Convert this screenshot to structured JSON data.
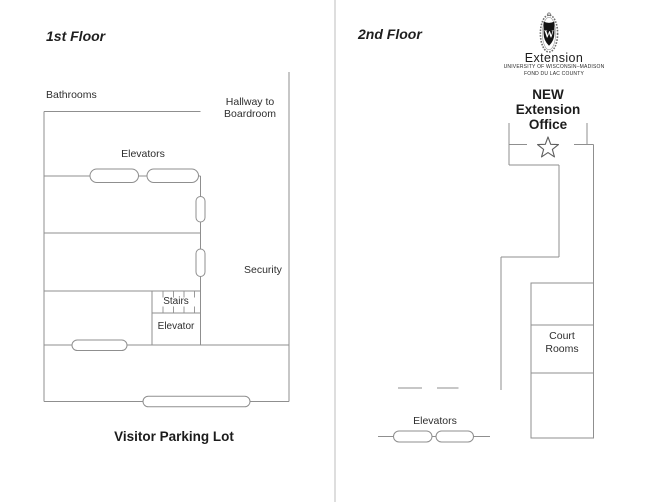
{
  "colors": {
    "wall_line": "#8f8f8f",
    "divider_line": "#c9c9c9",
    "text": "#2b2b2b",
    "star_stroke": "#5f5f5f",
    "crest_black": "#141414"
  },
  "floor1": {
    "title": "1st Floor",
    "labels": {
      "bathrooms": "Bathrooms",
      "hallway": "Hallway to\nBoardroom",
      "elevators": "Elevators",
      "security": "Security",
      "stairs": "Stairs",
      "elevator": "Elevator",
      "parking": "Visitor Parking Lot"
    }
  },
  "floor2": {
    "title": "2nd Floor",
    "logo": {
      "crest_letter": "W",
      "name": "Extension",
      "line1": "UNIVERSITY OF WISCONSIN–MADISON",
      "line2": "FOND DU LAC COUNTY"
    },
    "office_label": "NEW\nExtension\nOffice",
    "labels": {
      "court_rooms": "Court\nRooms",
      "elevators": "Elevators"
    }
  }
}
